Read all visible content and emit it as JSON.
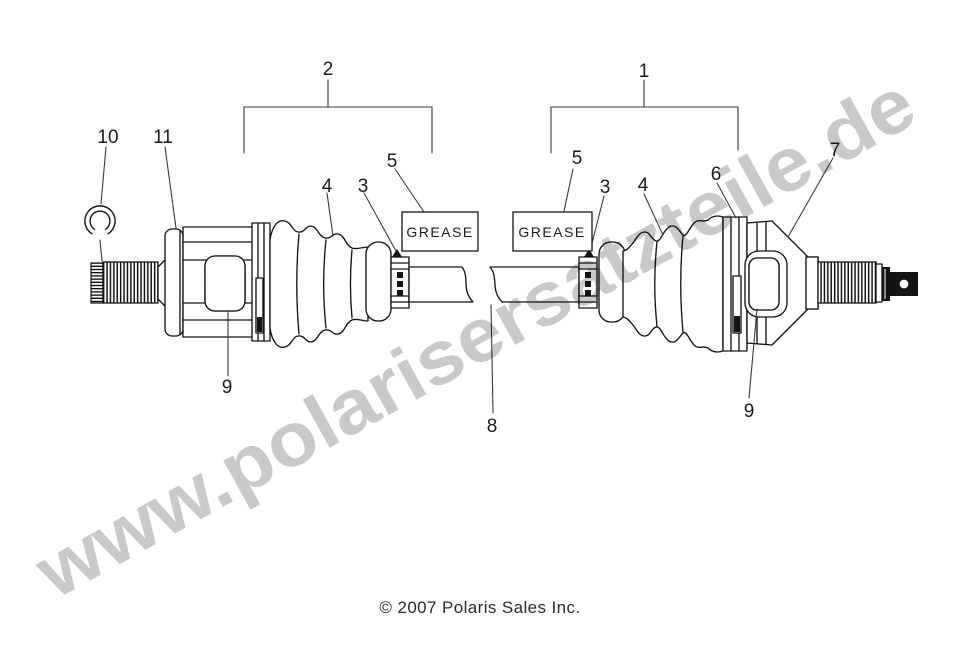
{
  "diagram": {
    "watermark": "www.polarisersatzteile.de",
    "copyright": "© 2007 Polaris Sales Inc.",
    "grease_left": "GREASE",
    "grease_right": "GREASE",
    "callouts": {
      "outer_joint_assembly": "1",
      "inner_joint_assembly": "2",
      "boot_clamp_small_left": "3",
      "boot_clamp_small_right": "3",
      "boot_left": "4",
      "boot_right": "4",
      "grease_note_left": "5",
      "grease_note_right": "5",
      "boot_clamp_large_right": "6",
      "outer_joint_housing": "7",
      "axle_shaft": "8",
      "bearing_left": "9",
      "bearing_right": "9",
      "snap_ring": "10",
      "inner_joint_housing": "11"
    },
    "colors": {
      "line": "#151515",
      "watermark": "#c5c5c5",
      "background": "#ffffff"
    }
  }
}
